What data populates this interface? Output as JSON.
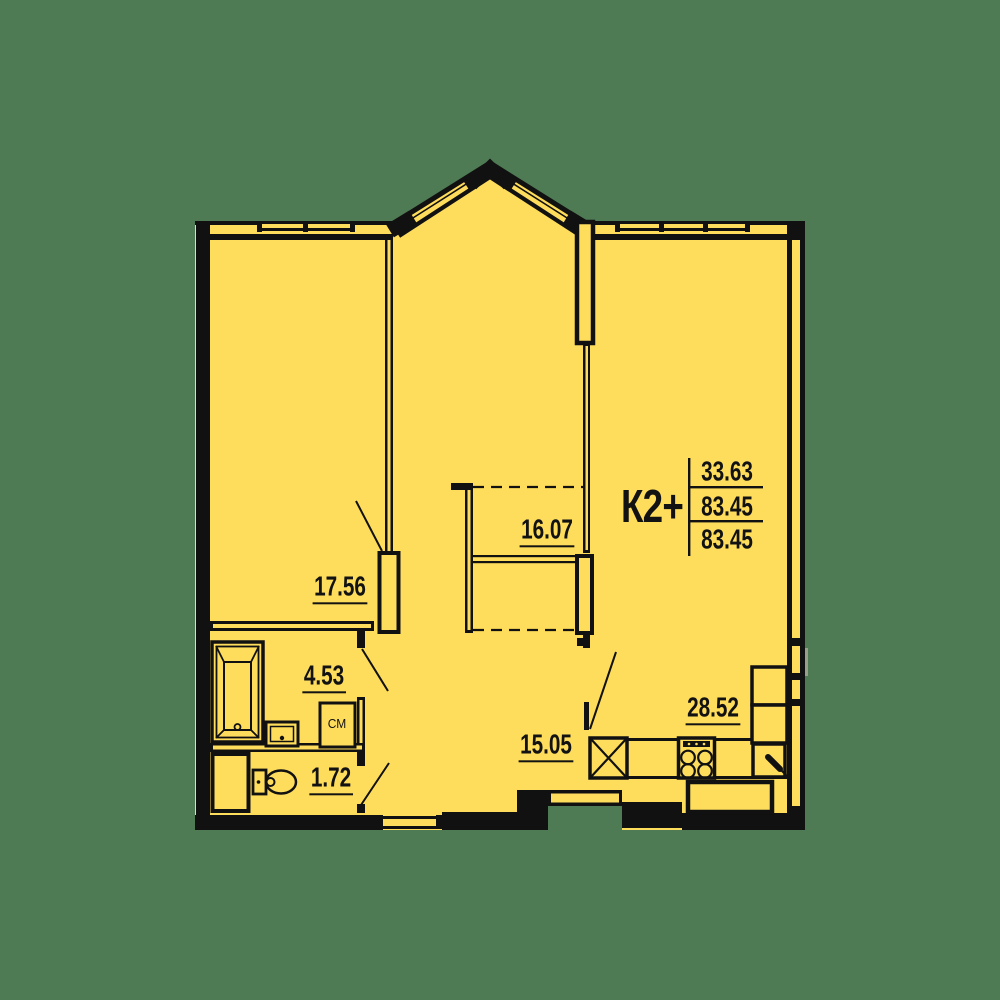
{
  "colors": {
    "bg": "#4e7b53",
    "fill": "#ffdd5c",
    "wall": "#111111"
  },
  "unit": {
    "code": "К2+",
    "areas": [
      "33.63",
      "83.45",
      "83.45"
    ]
  },
  "rooms": [
    {
      "name": "bedroom",
      "area": "17.56"
    },
    {
      "name": "wardrobe",
      "area": "16.07"
    },
    {
      "name": "bathroom",
      "area": "4.53"
    },
    {
      "name": "wc",
      "area": "1.72"
    },
    {
      "name": "hallway",
      "area": "15.05"
    },
    {
      "name": "kitchen-living",
      "area": "28.52"
    }
  ],
  "fixtures": {
    "washing_machine_label": "СМ"
  }
}
